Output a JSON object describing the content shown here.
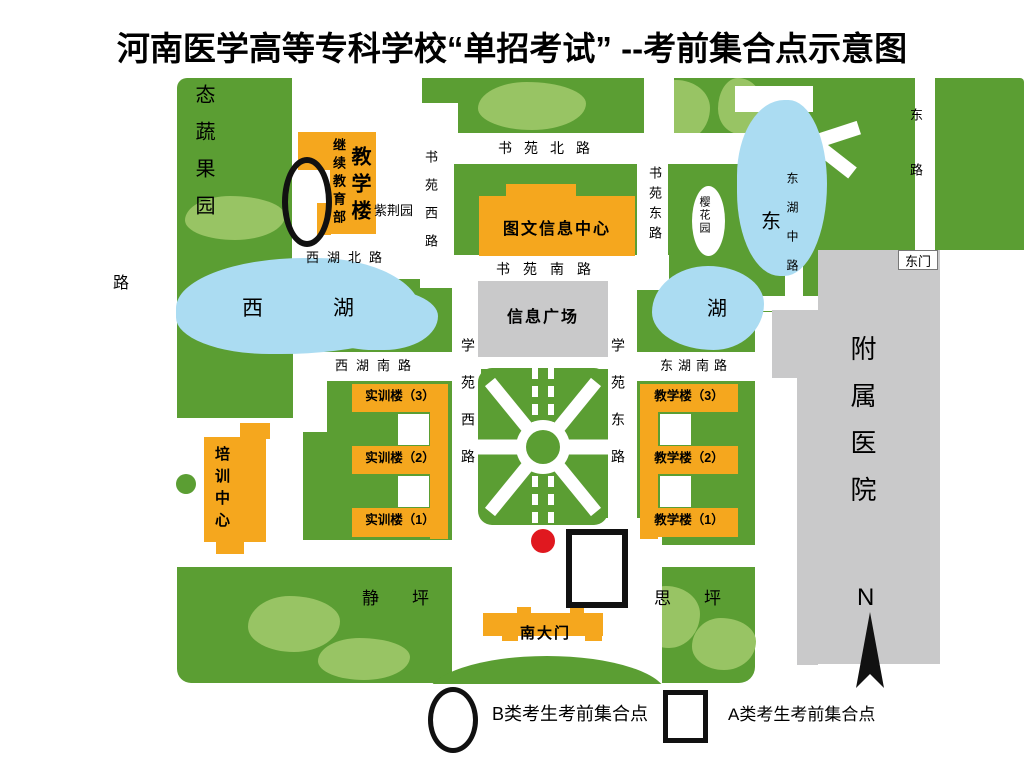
{
  "title": "河南医学高等专科学校“单招考试” --考前集合点示意图",
  "roads": {
    "outer_left": "路",
    "shuyuan_north": "书苑北路",
    "shuyuan_west": "书苑西路",
    "shuyuan_east": "书苑东路",
    "shuyuan_south": "书苑南路",
    "xihu_north": "西湖北路",
    "xihu_south": "西湖南路",
    "donghu_south": "东湖南路",
    "donghu_middle": "东湖中路",
    "xueyuan_west": "学苑西路",
    "xueyuan_east": "学苑东路",
    "east_road": "东路"
  },
  "areas": {
    "orchard": "态蔬果园",
    "zijing_garden": "紫荆园",
    "yinghua_garden": "樱花园",
    "info_plaza": "信息广场",
    "jing_lawn": "静坪",
    "si_lawn": "思坪",
    "hospital": "附属医院",
    "east_gate": "东门"
  },
  "lakes": {
    "west_xi": "西",
    "west_hu": "湖",
    "east_dong": "东",
    "east_hu": "湖"
  },
  "buildings": {
    "continuing_edu": "继续教育部",
    "teaching_building": "教学楼",
    "library": "图文信息中心",
    "training_center": "培训中心",
    "practice_3": "实训楼（3）",
    "practice_2": "实训楼（2）",
    "practice_1": "实训楼（1）",
    "teach_3": "教学楼（3）",
    "teach_2": "教学楼（2）",
    "teach_1": "教学楼（1）",
    "south_gate": "南大门"
  },
  "legend": {
    "b_label": "B类考生考前集合点",
    "a_label": "A类考生考前集合点"
  },
  "compass": {
    "north": "N"
  },
  "colors": {
    "campus_green": "#5b9e33",
    "tree_green": "#98c464",
    "lake_blue": "#abdcf2",
    "building_orange": "#f5a71e",
    "plaza_gray": "#c9c9ca",
    "marker_red": "#e0181f"
  }
}
